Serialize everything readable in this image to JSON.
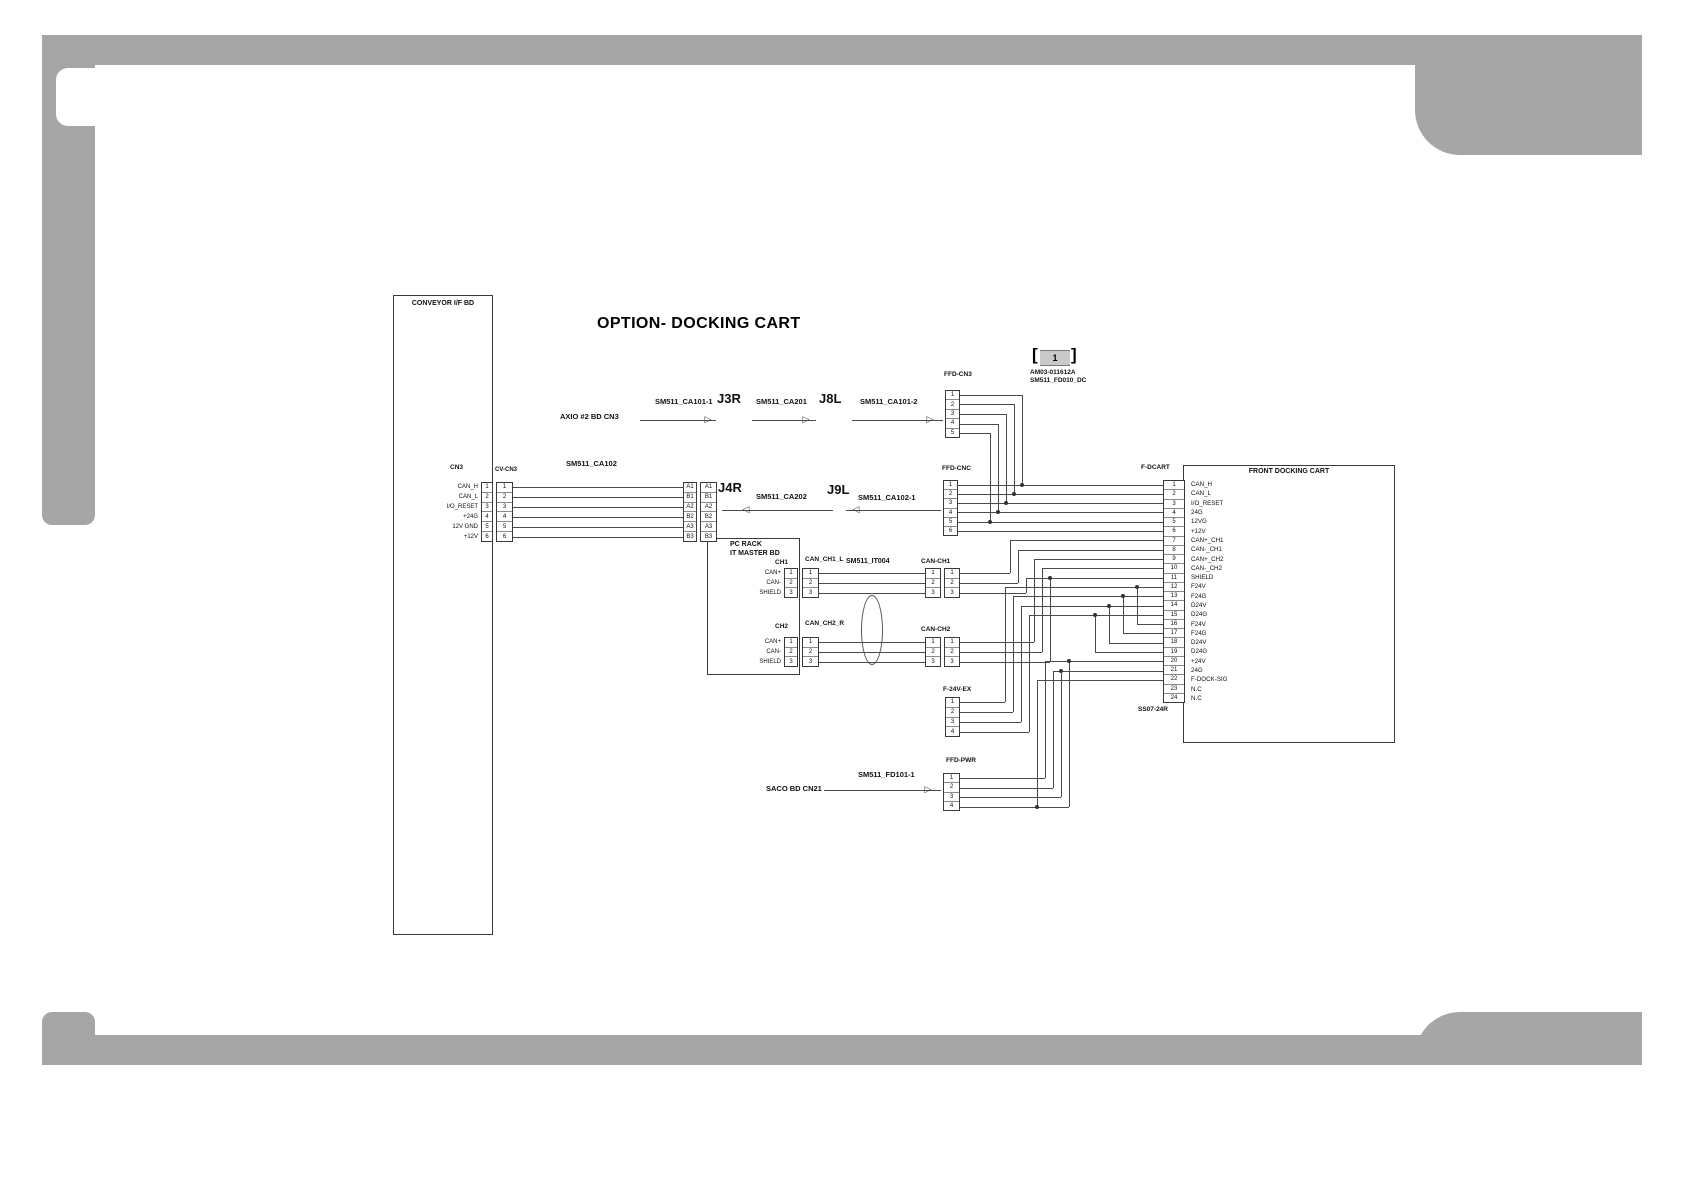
{
  "page": {
    "title": "OPTION- DOCKING CART"
  },
  "conveyor": {
    "title": "CONVEYOR I/F BD",
    "cn3_label": "CN3",
    "cv_cn3_label": "CV-CN3",
    "cable_label": "SM511_CA102",
    "pin_names": [
      "CAN_H",
      "CAN_L",
      "I/O_RESET",
      "+24G",
      "12V GND",
      "+12V"
    ],
    "pin_numbers": [
      "1",
      "2",
      "3",
      "4",
      "5",
      "6"
    ]
  },
  "top_chain": {
    "source": "AXIO #2 BD CN3",
    "cable1": "SM511_CA101-1",
    "conn1": "J3R",
    "cable2": "SM511_CA201",
    "conn2": "J8L",
    "cable3": "SM511_CA101-2"
  },
  "mid_chain": {
    "conn1": "J4R",
    "cable1": "SM511_CA202",
    "conn2": "J9L",
    "cable2": "SM511_CA102-1",
    "ab_pins": [
      "A1",
      "B1",
      "A2",
      "B2",
      "A3",
      "B3"
    ]
  },
  "ffd_cn3": {
    "label": "FFD-CN3",
    "pins": [
      "1",
      "2",
      "3",
      "4",
      "5"
    ],
    "marker": "1",
    "part_no": "AM03-011612A",
    "part_name": "SM511_FD010_DC"
  },
  "ffd_cnc": {
    "label": "FFD-CNC",
    "pins": [
      "1",
      "2",
      "3",
      "4",
      "5",
      "6"
    ]
  },
  "pc_rack": {
    "title1": "PC RACK",
    "title2": "IT MASTER BD",
    "cable_name": "SM511_IT004",
    "ch1": {
      "label": "CH1",
      "cable": "CAN_CH1_L",
      "pin_names": [
        "CAN+",
        "CAN-",
        "SHIELD"
      ],
      "pins": [
        "1",
        "2",
        "3"
      ]
    },
    "ch2": {
      "label": "CH2",
      "cable": "CAN_CH2_R",
      "pin_names": [
        "CAN+",
        "CAN-",
        "SHIELD"
      ],
      "pins": [
        "1",
        "2",
        "3"
      ]
    }
  },
  "can_ch1": {
    "label": "CAN-CH1",
    "pins": [
      "1",
      "2",
      "3"
    ]
  },
  "can_ch2": {
    "label": "CAN-CH2",
    "pins": [
      "1",
      "2",
      "3"
    ]
  },
  "f24_ex": {
    "label": "F-24V-EX",
    "pins": [
      "1",
      "2",
      "3",
      "4"
    ]
  },
  "ffd_pwr": {
    "label": "FFD-PWR",
    "source": "SACO BD CN21",
    "cable": "SM511_FD101-1",
    "pins": [
      "1",
      "2",
      "3",
      "4"
    ]
  },
  "front_cart": {
    "title": "FRONT DOCKING CART",
    "conn_label": "F-DCART",
    "bottom_label": "SS07-24R",
    "pins": [
      "1",
      "2",
      "3",
      "4",
      "5",
      "6",
      "7",
      "8",
      "9",
      "10",
      "11",
      "12",
      "13",
      "14",
      "15",
      "16",
      "17",
      "18",
      "19",
      "20",
      "21",
      "22",
      "23",
      "24"
    ],
    "pin_names": [
      "CAN_H",
      "CAN_L",
      "I/O_RESET",
      "24G",
      "12VG",
      "+12V",
      "CAN+_CH1",
      "CAN-_CH1",
      "CAN+_CH2",
      "CAN-_CH2",
      "SHIELD",
      "F24V",
      "F24G",
      "D24V",
      "D24G",
      "F24V",
      "F24G",
      "D24V",
      "D24G",
      "+24V",
      "24G",
      "F-DOCK-SIG",
      "N.C",
      "N.C"
    ]
  }
}
